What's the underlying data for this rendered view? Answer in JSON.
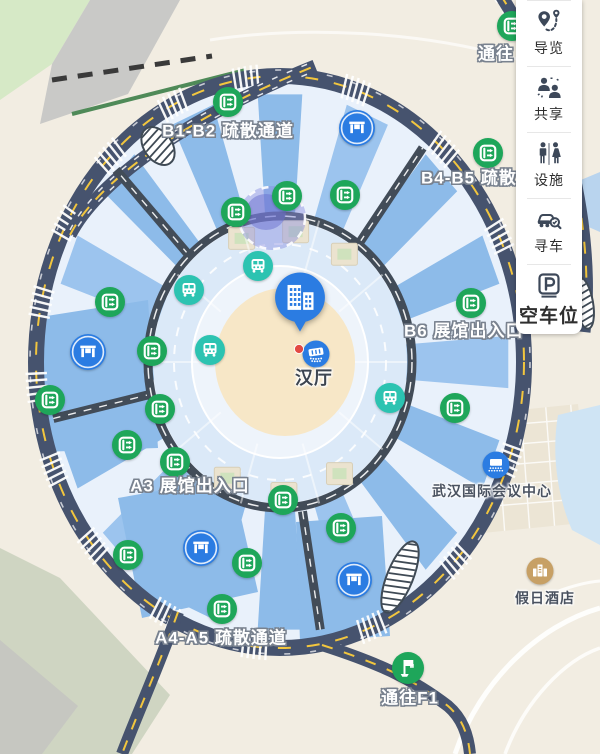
{
  "sidebar": {
    "items": [
      {
        "label": "导览",
        "icon": "guide-route-icon"
      },
      {
        "label": "共享",
        "icon": "share-people-icon"
      },
      {
        "label": "设施",
        "icon": "facilities-restroom-icon"
      },
      {
        "label": "寻车",
        "icon": "find-car-icon"
      },
      {
        "label": "空车位",
        "icon": "parking-icon"
      }
    ]
  },
  "map": {
    "colors": {
      "exit_green": "#1ea65a",
      "shuttle_teal": "#2cc3b1",
      "poi_blue": "#2b7ce2",
      "road_navy": "#46536e",
      "inner_road_gray": "#424c58",
      "lane_yellow": "#f2c63e",
      "hotel_gold": "#c7a065",
      "hall_fill": "#8dbbe9",
      "center_fill": "#f7e7c7"
    },
    "labels": [
      {
        "id": "b1b2",
        "text": "B1-B2 疏散通道",
        "x": 228,
        "y": 129,
        "style": "outline"
      },
      {
        "id": "b4b5",
        "text": "B4-B5 疏散通道",
        "x": 421,
        "y": 176,
        "style": "outline",
        "anchor": "w"
      },
      {
        "id": "b6",
        "text": "B6 展馆出入口",
        "x": 404,
        "y": 329,
        "style": "outline",
        "anchor": "w"
      },
      {
        "id": "a3",
        "text": "A3 展馆出入口",
        "x": 190,
        "y": 484,
        "style": "outline"
      },
      {
        "id": "a4a5",
        "text": "A4-A5 疏散通道",
        "x": 221,
        "y": 636,
        "style": "outline"
      },
      {
        "id": "f1",
        "text": "通往F1",
        "x": 410,
        "y": 696,
        "style": "outline"
      },
      {
        "id": "tongwang",
        "text": "通往",
        "x": 478,
        "y": 52,
        "style": "outline",
        "anchor": "w"
      },
      {
        "id": "conf",
        "text": "武汉国际会议中心",
        "x": 492,
        "y": 491,
        "style": "dark"
      },
      {
        "id": "hotel",
        "text": "假日酒店",
        "x": 545,
        "y": 598,
        "style": "dark"
      },
      {
        "id": "hanting",
        "text": "汉厅",
        "x": 314,
        "y": 377,
        "style": "dark-lg"
      }
    ],
    "markers": [
      {
        "type": "exit",
        "icon": "evacuation-route-icon",
        "x": 228,
        "y": 102
      },
      {
        "type": "exit",
        "icon": "evacuation-route-icon",
        "x": 488,
        "y": 153
      },
      {
        "type": "exit",
        "icon": "evacuation-route-icon",
        "x": 287,
        "y": 196
      },
      {
        "type": "exit",
        "icon": "evacuation-route-icon",
        "x": 345,
        "y": 195
      },
      {
        "type": "exit",
        "icon": "evacuation-route-icon",
        "x": 236,
        "y": 212
      },
      {
        "type": "exit",
        "icon": "evacuation-route-icon",
        "x": 471,
        "y": 303
      },
      {
        "type": "exit",
        "icon": "evacuation-route-icon",
        "x": 110,
        "y": 302
      },
      {
        "type": "exit",
        "icon": "evacuation-route-icon",
        "x": 152,
        "y": 351
      },
      {
        "type": "exit",
        "icon": "evacuation-route-icon",
        "x": 50,
        "y": 400
      },
      {
        "type": "exit",
        "icon": "evacuation-route-icon",
        "x": 160,
        "y": 409
      },
      {
        "type": "exit",
        "icon": "evacuation-route-icon",
        "x": 127,
        "y": 445
      },
      {
        "type": "exit",
        "icon": "evacuation-route-icon",
        "x": 175,
        "y": 462
      },
      {
        "type": "exit",
        "icon": "evacuation-route-icon",
        "x": 283,
        "y": 500
      },
      {
        "type": "exit",
        "icon": "evacuation-route-icon",
        "x": 341,
        "y": 528
      },
      {
        "type": "exit",
        "icon": "evacuation-route-icon",
        "x": 455,
        "y": 408
      },
      {
        "type": "exit",
        "icon": "evacuation-route-icon",
        "x": 128,
        "y": 555
      },
      {
        "type": "exit",
        "icon": "evacuation-route-icon",
        "x": 247,
        "y": 563
      },
      {
        "type": "exit",
        "icon": "evacuation-route-icon",
        "x": 222,
        "y": 609
      },
      {
        "type": "exit",
        "icon": "evacuation-route-icon",
        "x": 512,
        "y": 26
      },
      {
        "type": "bus",
        "icon": "shuttle-bus-icon",
        "x": 258,
        "y": 266
      },
      {
        "type": "bus",
        "icon": "shuttle-bus-icon",
        "x": 189,
        "y": 290
      },
      {
        "type": "bus",
        "icon": "shuttle-bus-icon",
        "x": 210,
        "y": 350
      },
      {
        "type": "bus",
        "icon": "shuttle-bus-icon",
        "x": 390,
        "y": 398
      },
      {
        "type": "hall",
        "icon": "hall-entrance-icon",
        "x": 357,
        "y": 128
      },
      {
        "type": "hall",
        "icon": "hall-entrance-icon",
        "x": 88,
        "y": 352
      },
      {
        "type": "hall",
        "icon": "hall-entrance-icon",
        "x": 201,
        "y": 548
      },
      {
        "type": "hall",
        "icon": "hall-entrance-icon",
        "x": 354,
        "y": 580
      },
      {
        "type": "conference",
        "icon": "conference-icon",
        "x": 496,
        "y": 465
      },
      {
        "type": "hotel",
        "icon": "hotel-icon",
        "x": 540,
        "y": 571
      },
      {
        "type": "f1flag",
        "icon": "flag-icon",
        "x": 408,
        "y": 668
      },
      {
        "type": "pin",
        "icon": "building-pin-icon",
        "x": 300,
        "y": 297
      },
      {
        "type": "stage",
        "icon": "stage-icon",
        "x": 316,
        "y": 354
      },
      {
        "type": "reddot",
        "icon": "location-dot",
        "x": 299,
        "y": 349
      }
    ]
  }
}
